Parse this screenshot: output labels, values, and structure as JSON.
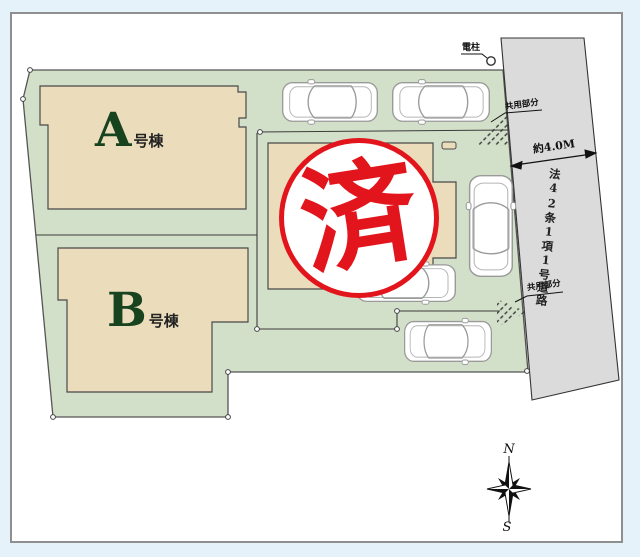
{
  "site_plan": {
    "buildings": [
      {
        "letter": "A",
        "suffix": "号棟"
      },
      {
        "letter": "B",
        "suffix": "号棟"
      }
    ],
    "stamp": {
      "text": "済"
    },
    "road": {
      "name": "法42条1項1号道路",
      "width": "約4.0M"
    },
    "labels": {
      "utility_pole": "電柱",
      "shared_top": "共用部分",
      "shared_bottom": "共用部分"
    },
    "compass": {
      "north": "N",
      "south": "S"
    },
    "colors": {
      "plot_green": "#d3e0c9",
      "building_beige": "#ebddbc",
      "road_gray": "#dbdbdb",
      "stamp_red": "#e3151c"
    }
  }
}
